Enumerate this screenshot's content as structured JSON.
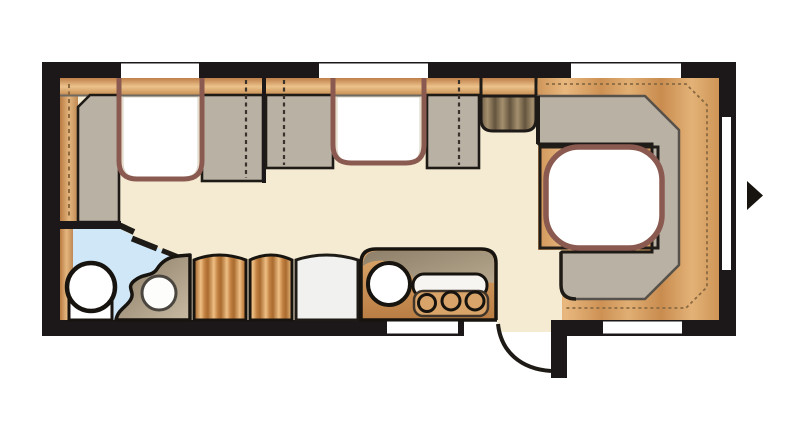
{
  "palette": {
    "page-bg": "#ffffff",
    "wall": "#1c1719",
    "ink": "#1e1a16",
    "floor": "#f4ebd2",
    "wood-light": "#ecc28c",
    "wood-mid": "#d09b60",
    "wood-deep": "#b97b42",
    "upholstery": "#bab1a5",
    "upholstery-outline": "#56514a",
    "table-border": "#8a5a50",
    "bath-blue": "#cfe7f7",
    "fixture-taupe": "#8d7f69",
    "kitchen-orange": "#c98f55",
    "fridge-white": "#f1f1ef",
    "dash-brown": "#8a6a42",
    "window-white": "#ffffff"
  },
  "plan": {
    "kind": "caravan-floorplan",
    "entry_side": "bottom-right",
    "exterior_arrow_direction": "right"
  }
}
